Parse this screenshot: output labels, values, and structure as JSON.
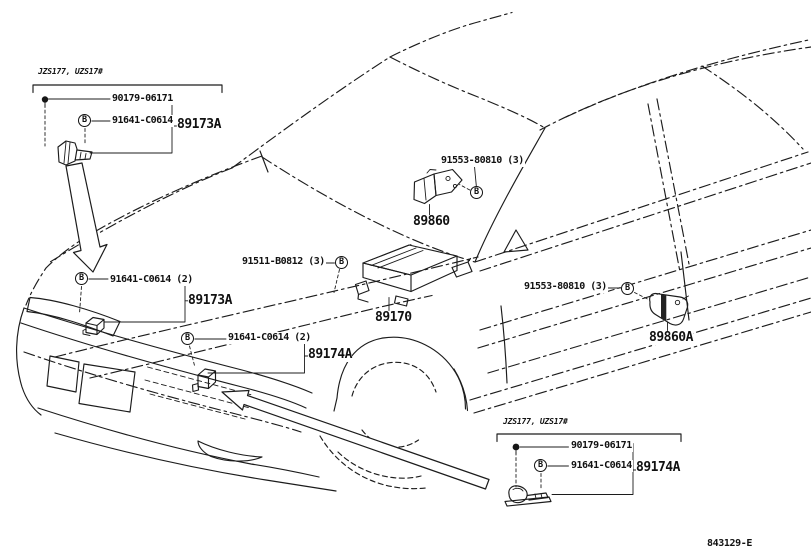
{
  "drawing_code": "843129-E",
  "callouts": {
    "front_sensor_detail_box": {
      "variant": "JZS177, UZS17#",
      "bolt_part": "90179-06171",
      "clip_part": "91641-C0614",
      "marker": "B",
      "group": "89173A"
    },
    "front_fender_sensor": {
      "marker": "B",
      "part": "91641-C0614 (2)",
      "group": "89173A"
    },
    "center_airbag_sensor": {
      "part": "91511-B0812 (3)",
      "marker": "B",
      "label": "89170"
    },
    "front_airbag_sensor": {
      "part": "91553-80810 (3)",
      "marker": "B",
      "label": "89860"
    },
    "side_airbag_sensor": {
      "part": "91553-80810 (3)",
      "marker": "B",
      "label": "89860A"
    },
    "front_bumper_sensor": {
      "marker": "B",
      "part": "91641-C0614 (2)",
      "group": "89174A"
    },
    "rear_sensor_detail_box": {
      "variant": "JZS177, UZS17#",
      "bolt_part": "90179-06171",
      "clip_part": "91641-C0614",
      "marker": "B",
      "group": "89174A"
    }
  }
}
